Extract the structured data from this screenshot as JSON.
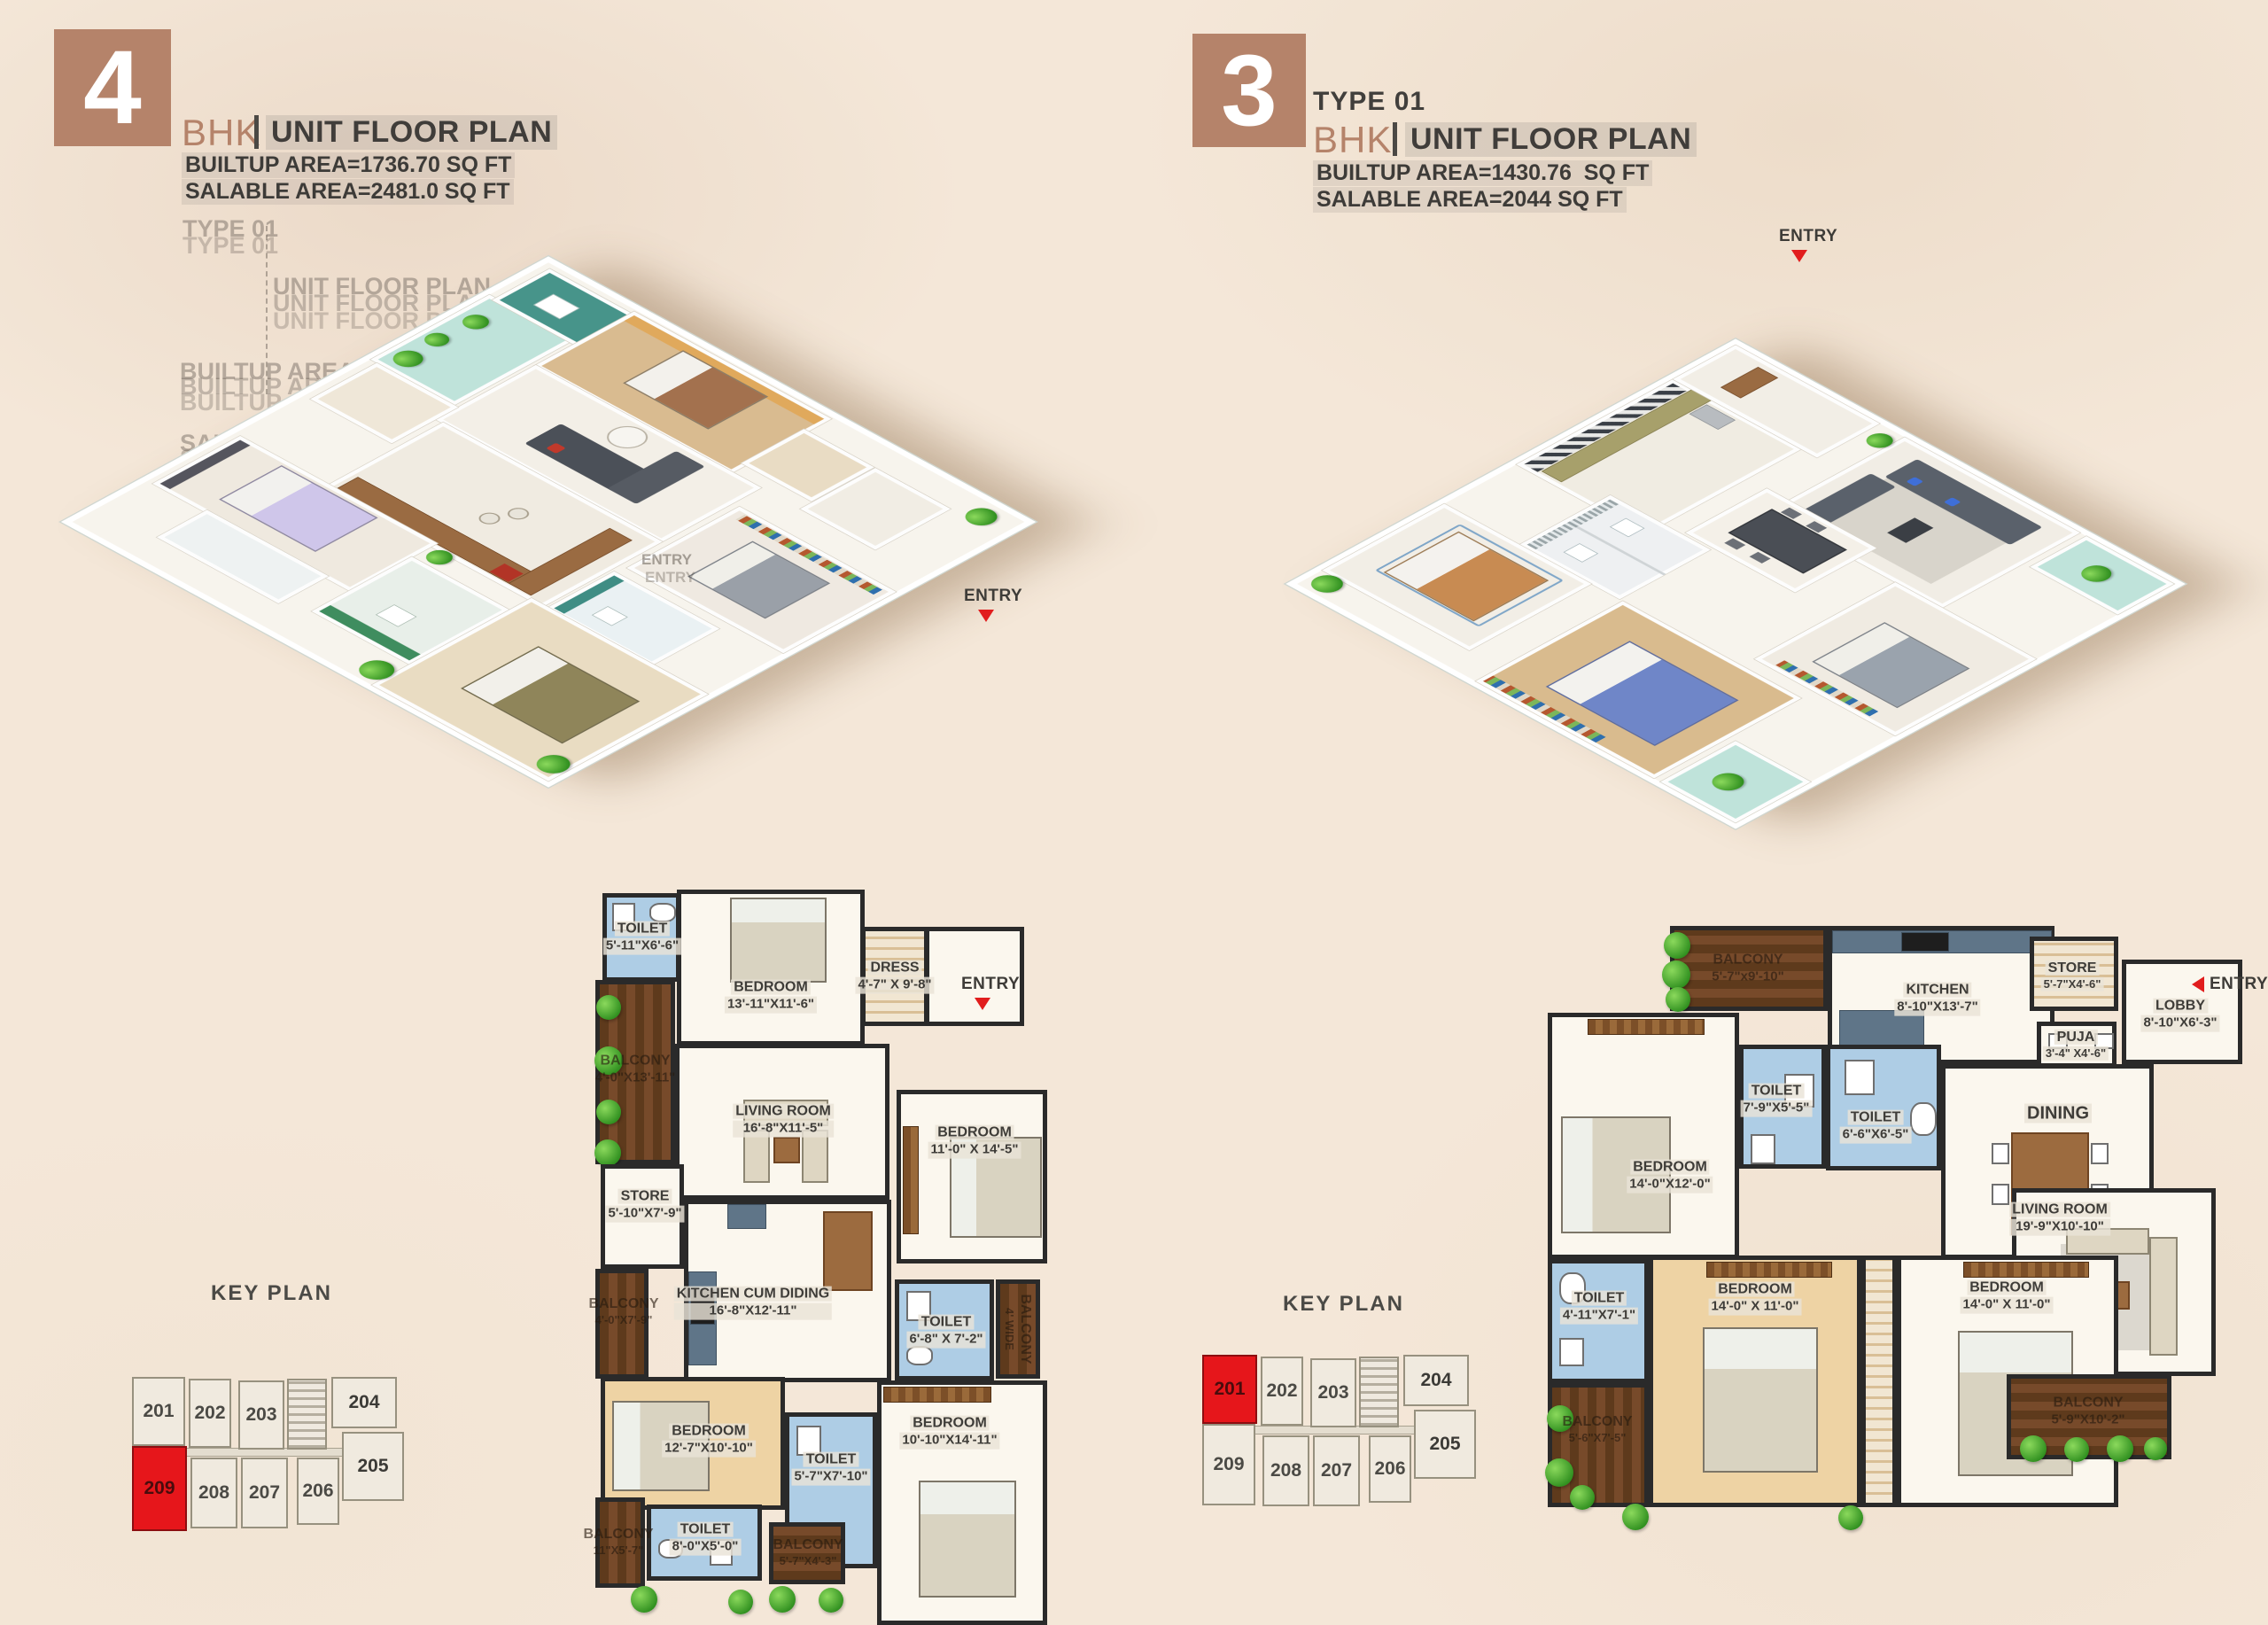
{
  "colors": {
    "accent_brown": "#b5836a",
    "entry_red": "#e11d1d",
    "keyplan_red": "#e6161b",
    "wall_dark": "#2a2a2a",
    "toilet_blue": "#aecde5"
  },
  "left_unit": {
    "header": {
      "number": "4",
      "bhk_label": "BHK",
      "title": "UNIT FLOOR PLAN",
      "builtup": "BUILTUP AREA=1736.70 SQ FT",
      "salable": "SALABLE AREA=2481.0 SQ FT"
    },
    "ghost": {
      "type": "TYPE 01",
      "title": "UNIT FLOOR PLAN",
      "builtup_a": "BUILTUP AREA=1736.70 SQ FT",
      "builtup_b": "BUILTUP AREA=1430.76 SQ FT",
      "salable_a": "SALABLE AREA=2481.0 SQ FT",
      "salable_b": "SALABLE AREA=2044 SQ FT",
      "entry": "ENTRY"
    },
    "iso_entry": "ENTRY",
    "plan": {
      "entry": "ENTRY",
      "rooms": {
        "toilet_top": {
          "name": "TOILET",
          "dims": "5'-11\"X6'-6\""
        },
        "bedroom_top": {
          "name": "BEDROOM",
          "dims": "13'-11\"X11'-6\""
        },
        "dress": {
          "name": "DRESS",
          "dims": "4'-7\" X 9'-8\""
        },
        "balcony_left": {
          "name": "BALCONY",
          "dims": "4'-0\"X13'-11\""
        },
        "living": {
          "name": "LIVING ROOM",
          "dims": "16'-8\"X11'-5\""
        },
        "bedroom_right": {
          "name": "BEDROOM",
          "dims": "11'-0\" X 14'-5\""
        },
        "store": {
          "name": "STORE",
          "dims": "5'-10\"X7'-9\""
        },
        "balcony_left2": {
          "name": "BALCONY",
          "dims": "4'-0\"X7'-9\""
        },
        "kitchen": {
          "name": "KITCHEN CUM DIDING",
          "dims": "16'-8\"X12'-11\""
        },
        "toilet_mid": {
          "name": "TOILET",
          "dims": "6'-8\" X 7'-2\""
        },
        "balcony_right": {
          "name": "BALCONY",
          "dims": "4' WIDE"
        },
        "bedroom_bl": {
          "name": "BEDROOM",
          "dims": "12'-7\"X10'-10\""
        },
        "toilet_center": {
          "name": "TOILET",
          "dims": "5'-7\"X7'-10\""
        },
        "bedroom_br": {
          "name": "BEDROOM",
          "dims": "10'-10\"X14'-11\""
        },
        "toilet_bottom": {
          "name": "TOILET",
          "dims": "8'-0\"X5'-0\""
        },
        "balcony_bottom": {
          "name": "BALCONY",
          "dims": "5'-7\"X4'-3\""
        },
        "balcony_bl": {
          "name": "BALCONY",
          "dims": "11\"X5'-7\""
        }
      }
    },
    "keyplan": {
      "title": "KEY PLAN",
      "highlighted_unit": "209",
      "units": {
        "u201": "201",
        "u202": "202",
        "u203": "203",
        "u204": "204",
        "u205": "205",
        "u206": "206",
        "u207": "207",
        "u208": "208",
        "u209": "209"
      }
    }
  },
  "right_unit": {
    "header": {
      "number": "3",
      "type": "TYPE 01",
      "bhk_label": "BHK",
      "title": "UNIT FLOOR PLAN",
      "builtup": "BUILTUP AREA=1430.76  SQ FT",
      "salable": "SALABLE AREA=2044 SQ FT"
    },
    "iso_entry": "ENTRY",
    "plan": {
      "entry": "ENTRY",
      "rooms": {
        "balcony_top": {
          "name": "BALCONY",
          "dims": "5'-7\"x9'-10\""
        },
        "kitchen": {
          "name": "KITCHEN",
          "dims": "8'-10\"X13'-7\""
        },
        "store": {
          "name": "STORE",
          "dims": "5'-7\"X4'-6\""
        },
        "lobby": {
          "name": "LOBBY",
          "dims": "8'-10\"X6'-3\""
        },
        "puja": {
          "name": "PUJA",
          "dims": "3'-4\" X4'-6\""
        },
        "toilet_a": {
          "name": "TOILET",
          "dims": "7'-9\"X5'-5\""
        },
        "toilet_b": {
          "name": "TOILET",
          "dims": "6'-6\"X6'-5\""
        },
        "dining": {
          "name": "DINING",
          "dims": ""
        },
        "bedroom_tl": {
          "name": "BEDROOM",
          "dims": "14'-0\"X12'-0\""
        },
        "living": {
          "name": "LIVING ROOM",
          "dims": "19'-9\"X10'-10\""
        },
        "toilet_c": {
          "name": "TOILET",
          "dims": "4'-11\"X7'-1\""
        },
        "bedroom_b1": {
          "name": "BEDROOM",
          "dims": "14'-0\" X 11'-0\""
        },
        "bedroom_b2": {
          "name": "BEDROOM",
          "dims": "14'-0\" X 11'-0\""
        },
        "balcony_left": {
          "name": "BALCONY",
          "dims": "5'-6\"X7'-5\""
        },
        "balcony_bottom": {
          "name": "BALCONY",
          "dims": "5'-9\"X10'-2\""
        }
      }
    },
    "keyplan": {
      "title": "KEY PLAN",
      "highlighted_unit": "201",
      "units": {
        "u201": "201",
        "u202": "202",
        "u203": "203",
        "u204": "204",
        "u205": "205",
        "u206": "206",
        "u207": "207",
        "u208": "208",
        "u209": "209"
      }
    }
  }
}
